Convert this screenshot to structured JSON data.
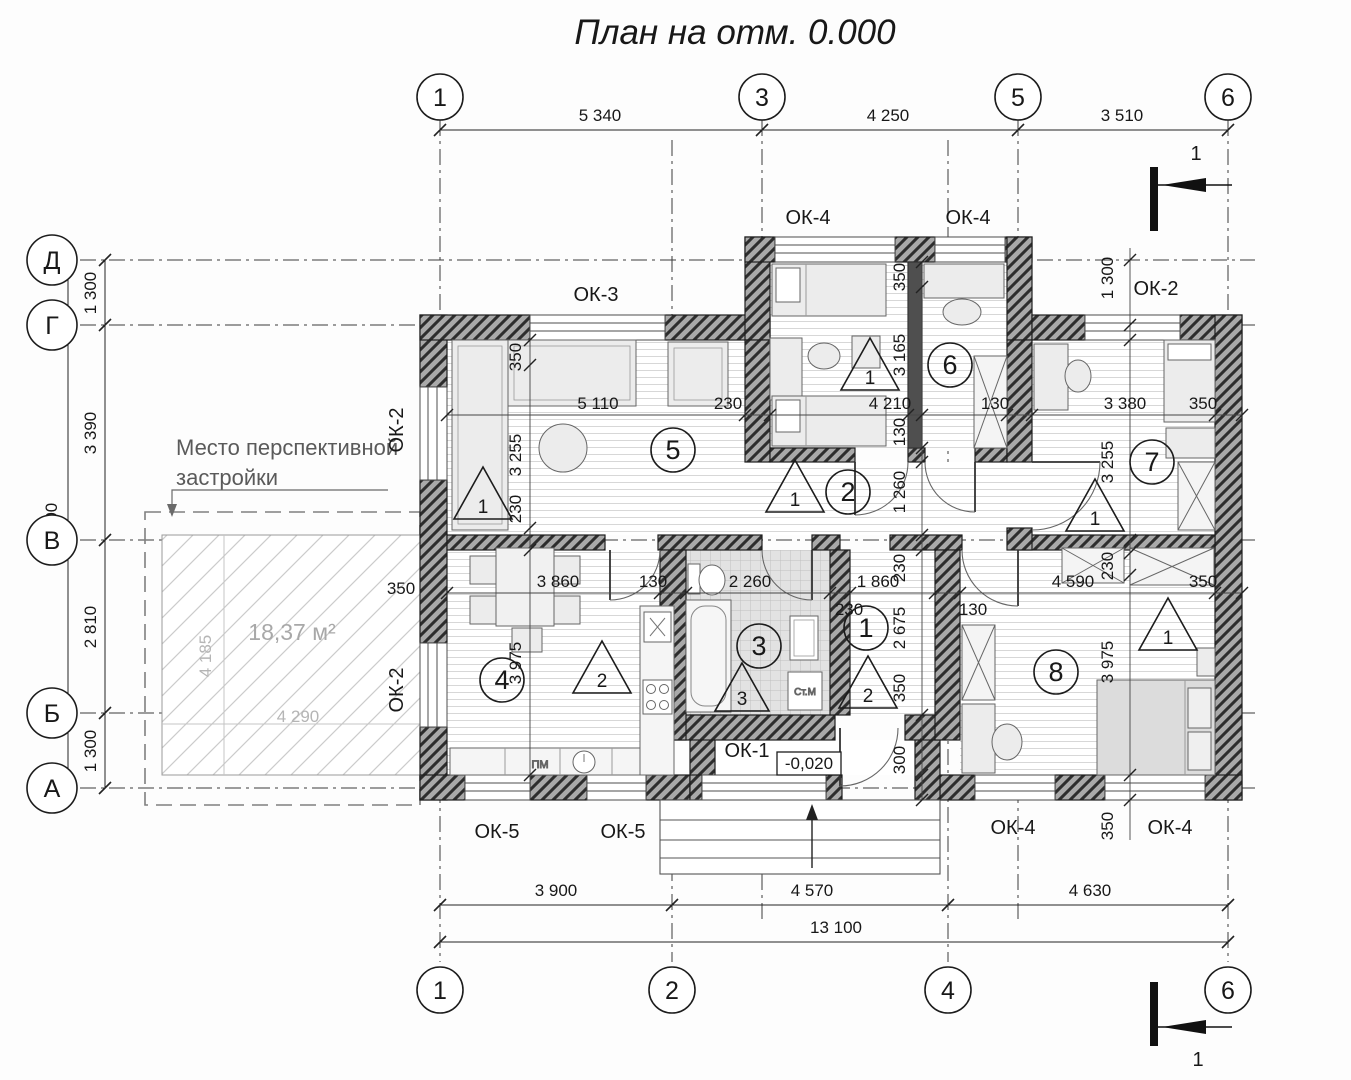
{
  "title": "План на отм. 0.000",
  "axes": {
    "top": [
      "1",
      "3",
      "5",
      "6"
    ],
    "bottom": [
      "1",
      "2",
      "4",
      "6"
    ],
    "left": [
      "Д",
      "Г",
      "В",
      "Б",
      "А"
    ]
  },
  "dims": {
    "top": [
      "5 340",
      "4 250",
      "3 510"
    ],
    "bottom": [
      "3 900",
      "4 570",
      "4 630"
    ],
    "bottomTotal": "13 100",
    "left": [
      "1 300",
      "3 390",
      "2 810",
      "1 300"
    ],
    "leftTotal": "8 800",
    "chainMid": [
      "5 110",
      "230",
      "4 210",
      "130",
      "3 380",
      "350"
    ],
    "chainLow": [
      "3 860",
      "130",
      "2 260",
      "1 860",
      "4 590",
      "350"
    ],
    "lowExtra": [
      "230",
      "130"
    ],
    "colLeft": [
      "350",
      "3 255",
      "230",
      "3 975"
    ],
    "colCenter": [
      "350",
      "3 165",
      "130",
      "1 260",
      "230",
      "2 675",
      "350",
      "300"
    ],
    "colRight": [
      "1 300",
      "3 255",
      "230",
      "3 975",
      "350"
    ],
    "wallOffset": "350"
  },
  "windows": {
    "ok1": "ОК-1",
    "ok2": "ОК-2",
    "ok3": "ОК-3",
    "ok4": "ОК-4",
    "ok5": "ОК-5"
  },
  "rooms": [
    "1",
    "2",
    "3",
    "4",
    "5",
    "6",
    "7",
    "8"
  ],
  "floorMarks": [
    "1",
    "2",
    "3"
  ],
  "level": "-0,020",
  "terrace": {
    "area": "18,37 м²",
    "width": "4 290",
    "height": "4 185"
  },
  "note": [
    "Место перспективной",
    "застройки"
  ],
  "appliances": {
    "washer": "Ст.М",
    "dishwasher": "ПМ"
  },
  "section": "1"
}
